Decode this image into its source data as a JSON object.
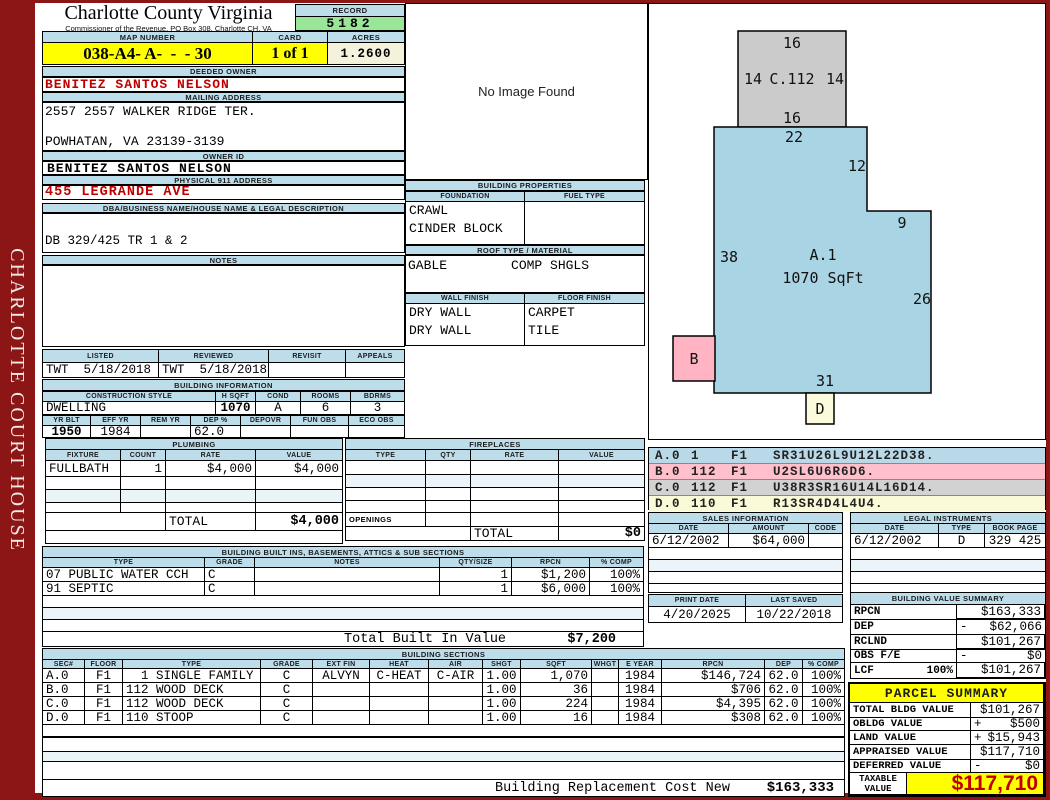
{
  "sidebar": {
    "title": "CHARLOTTE COURT HOUSE"
  },
  "header": {
    "county": "Charlotte County Virginia",
    "commissioner_line": "Commissioner of the Revenue, PO Box 308, Charlotte CH, VA",
    "record_label": "RECORD",
    "record": "5182",
    "map_number_label": "MAP NUMBER",
    "map_number": "038-A4- A-  -  - 30",
    "card_label": "CARD",
    "card": "1 of 1",
    "acres_label": "ACRES",
    "acres": "1.2600"
  },
  "owner": {
    "deeded_owner_label": "DEEDED OWNER",
    "deeded_owner": "BENITEZ SANTOS NELSON",
    "mailing_address_label": "MAILING ADDRESS",
    "mailing_address_line1": "2557 2557 WALKER RIDGE TER.",
    "mailing_address_line2": "POWHATAN, VA 23139-3139",
    "owner_id_label": "OWNER ID",
    "owner_id": "BENITEZ SANTOS NELSON",
    "physical_address_label": "PHYSICAL 911 ADDRESS",
    "physical_address": "455 LEGRANDE AVE",
    "dba_label": "DBA/BUSINESS NAME/HOUSE NAME & LEGAL DESCRIPTION",
    "legal_description": "DB 329/425 TR 1 & 2",
    "notes_label": "NOTES",
    "notes": ""
  },
  "photo": {
    "message": "No Image Found"
  },
  "building_properties": {
    "title": "BUILDING PROPERTIES",
    "foundation_label": "FOUNDATION",
    "foundation_line1": "CRAWL",
    "foundation_line2": "CINDER BLOCK",
    "fuel_type_label": "FUEL TYPE",
    "fuel_type": "",
    "roof_label": "ROOF TYPE / MATERIAL",
    "roof_type": "GABLE",
    "roof_material": "COMP SHGLS",
    "wall_finish_label": "WALL FINISH",
    "wall_finish_line1": "DRY WALL",
    "wall_finish_line2": "DRY WALL",
    "floor_finish_label": "FLOOR FINISH",
    "floor_finish_line1": "CARPET",
    "floor_finish_line2": "TILE"
  },
  "review": {
    "listed_label": "LISTED",
    "listed": "TWT  5/18/2018",
    "reviewed_label": "REVIEWED",
    "reviewed": "TWT  5/18/2018",
    "revisit_label": "REVISIT",
    "revisit": "",
    "appeals_label": "APPEALS",
    "appeals": ""
  },
  "building_information": {
    "title": "BUILDING INFORMATION",
    "style_label": "CONSTRUCTION STYLE",
    "style": "DWELLING",
    "hsqft_label": "H SQFT",
    "hsqft": "1070",
    "cond_label": "COND",
    "cond": "A",
    "rooms_label": "ROOMS",
    "rooms": "6",
    "bdrms_label": "BDRMS",
    "bdrms": "3",
    "yrblt_label": "YR BLT",
    "yrblt": "1950",
    "effyr_label": "EFF YR",
    "effyr": "1984",
    "remyr_label": "REM YR",
    "remyr": "",
    "dep_label": "DEP %",
    "dep": "62.0",
    "depovr_label": "DEPOVR",
    "depovr": "",
    "funobs_label": "FUN OBS",
    "funobs": "",
    "ecoobs_label": "ECO OBS",
    "ecoobs": ""
  },
  "plumbing": {
    "title": "PLUMBING",
    "headers": [
      "FIXTURE",
      "COUNT",
      "RATE",
      "VALUE"
    ],
    "rows": [
      {
        "fixture": "FULLBATH",
        "count": "1",
        "rate": "$4,000",
        "value": "$4,000"
      }
    ],
    "total_label": "TOTAL",
    "total": "$4,000"
  },
  "fireplaces": {
    "title": "FIREPLACES",
    "headers": [
      "TYPE",
      "QTY",
      "RATE",
      "VALUE"
    ],
    "openings_label": "OPENINGS",
    "total_label": "TOTAL",
    "total": "$0"
  },
  "built_ins": {
    "title": "BUILDING BUILT INS, BASEMENTS, ATTICS & SUB SECTIONS",
    "headers": [
      "TYPE",
      "GRADE",
      "NOTES",
      "QTY/SIZE",
      "RPCN",
      "% COMP"
    ],
    "rows": [
      {
        "type": "07 PUBLIC WATER CCH",
        "grade": "C",
        "notes": "",
        "qty": "1",
        "rpcn": "$1,200",
        "comp": "100%"
      },
      {
        "type": "91 SEPTIC",
        "grade": "C",
        "notes": "",
        "qty": "1",
        "rpcn": "$6,000",
        "comp": "100%"
      }
    ],
    "total_label": "Total Built In Value",
    "total": "$7,200"
  },
  "building_sections": {
    "title": "BUILDING SECTIONS",
    "headers": [
      "SEC#",
      "FLOOR",
      "TYPE",
      "GRADE",
      "EXT FIN",
      "HEAT",
      "AIR",
      "SHGT",
      "SQFT",
      "WHGT",
      "E YEAR",
      "RPCN",
      "DEP",
      "% COMP"
    ],
    "rows": [
      {
        "sec": "A.0",
        "floor": "F1",
        "type": "  1 SINGLE FAMILY",
        "grade": "C",
        "extfin": "ALVYN",
        "heat": "C-HEAT",
        "air": "C-AIR",
        "shgt": "1.00",
        "sqft": "1,070",
        "whgt": "",
        "eyear": "1984",
        "rpcn": "$146,724",
        "dep": "62.0",
        "comp": "100%"
      },
      {
        "sec": "B.0",
        "floor": "F1",
        "type": "112 WOOD DECK",
        "grade": "C",
        "extfin": "",
        "heat": "",
        "air": "",
        "shgt": "1.00",
        "sqft": "36",
        "whgt": "",
        "eyear": "1984",
        "rpcn": "$706",
        "dep": "62.0",
        "comp": "100%"
      },
      {
        "sec": "C.0",
        "floor": "F1",
        "type": "112 WOOD DECK",
        "grade": "C",
        "extfin": "",
        "heat": "",
        "air": "",
        "shgt": "1.00",
        "sqft": "224",
        "whgt": "",
        "eyear": "1984",
        "rpcn": "$4,395",
        "dep": "62.0",
        "comp": "100%"
      },
      {
        "sec": "D.0",
        "floor": "F1",
        "type": "110 STOOP",
        "grade": "C",
        "extfin": "",
        "heat": "",
        "air": "",
        "shgt": "1.00",
        "sqft": "16",
        "whgt": "",
        "eyear": "1984",
        "rpcn": "$308",
        "dep": "62.0",
        "comp": "100%"
      }
    ]
  },
  "vectors": {
    "rows": [
      {
        "sec": "A.0",
        "code": "1",
        "floor": "F1",
        "path": "SR31U26L9U12L22D38.",
        "color": "#B9D9E8"
      },
      {
        "sec": "B.0",
        "code": "112",
        "floor": "F1",
        "path": "U2SL6U6R6D6.",
        "color": "#FFC0CB"
      },
      {
        "sec": "C.0",
        "code": "112",
        "floor": "F1",
        "path": "U38R3SR16U14L16D14.",
        "color": "#D2D2D2"
      },
      {
        "sec": "D.0",
        "code": "110",
        "floor": "F1",
        "path": "R13SR4D4L4U4.",
        "color": "#FAFAD8"
      }
    ]
  },
  "sketch": {
    "c_label": "C.112",
    "c_top": "16",
    "c_left": "14",
    "c_right": "14",
    "c_bottom": "16",
    "a_label": "A.1",
    "a_area": "1070 SqFt",
    "a_top": "22",
    "a_right_upper": "12",
    "a_step": "9",
    "a_left": "38",
    "a_right": "26",
    "a_bottom": "31",
    "b_label": "B",
    "d_label": "D"
  },
  "sales": {
    "title": "SALES INFORMATION",
    "headers": [
      "DATE",
      "AMOUNT",
      "CODE"
    ],
    "rows": [
      {
        "date": "6/12/2002",
        "amount": "$64,000",
        "code": ""
      }
    ]
  },
  "legal": {
    "title": "LEGAL INSTRUMENTS",
    "headers": [
      "DATE",
      "TYPE",
      "BOOK PAGE"
    ],
    "rows": [
      {
        "date": "6/12/2002",
        "type": "D",
        "book_page": "329 425"
      }
    ]
  },
  "print_info": {
    "print_date_label": "PRINT DATE",
    "print_date": "4/20/2025",
    "last_saved_label": "LAST SAVED",
    "last_saved": "10/22/2018"
  },
  "value_summary": {
    "title": "BUILDING VALUE SUMMARY",
    "rows": [
      {
        "label": "RPCN",
        "sign": "",
        "value": "$163,333"
      },
      {
        "label": "DEP",
        "sign": "-",
        "value": "$62,066"
      },
      {
        "label": "RCLND",
        "sign": "",
        "value": "$101,267"
      },
      {
        "label": "OBS F/E",
        "sign": "-",
        "value": "$0"
      },
      {
        "label": "LCF",
        "pct": "100%",
        "sign": "",
        "value": "$101,267"
      }
    ]
  },
  "parcel_summary": {
    "title": "PARCEL SUMMARY",
    "rows": [
      {
        "label": "TOTAL BLDG VALUE",
        "sign": "",
        "value": "$101,267"
      },
      {
        "label": "OBLDG VALUE",
        "sign": "+",
        "value": "$500"
      },
      {
        "label": "LAND VALUE",
        "sign": "+",
        "value": "$15,943"
      },
      {
        "label": "APPRAISED VALUE",
        "sign": "",
        "value": "$117,710"
      },
      {
        "label": "DEFERRED VALUE",
        "sign": "-",
        "value": "$0"
      }
    ],
    "taxable_label": "TAXABLE VALUE",
    "taxable_value": "$117,710"
  },
  "replacement": {
    "label": "Building Replacement Cost New",
    "value": "$163,333"
  },
  "colors": {
    "sidebar_red": "#8C1616",
    "header_blue": "#BEDDEB",
    "highlight_yellow": "#FFFF00",
    "record_green": "#99E699",
    "acres_cream": "#F5F2DC",
    "accent_red": "#C00000",
    "sketch_blue": "#A9D4E4",
    "sketch_gray": "#CBCBCB",
    "sketch_pink": "#FFB3C3",
    "sketch_cream": "#FCFADC"
  }
}
